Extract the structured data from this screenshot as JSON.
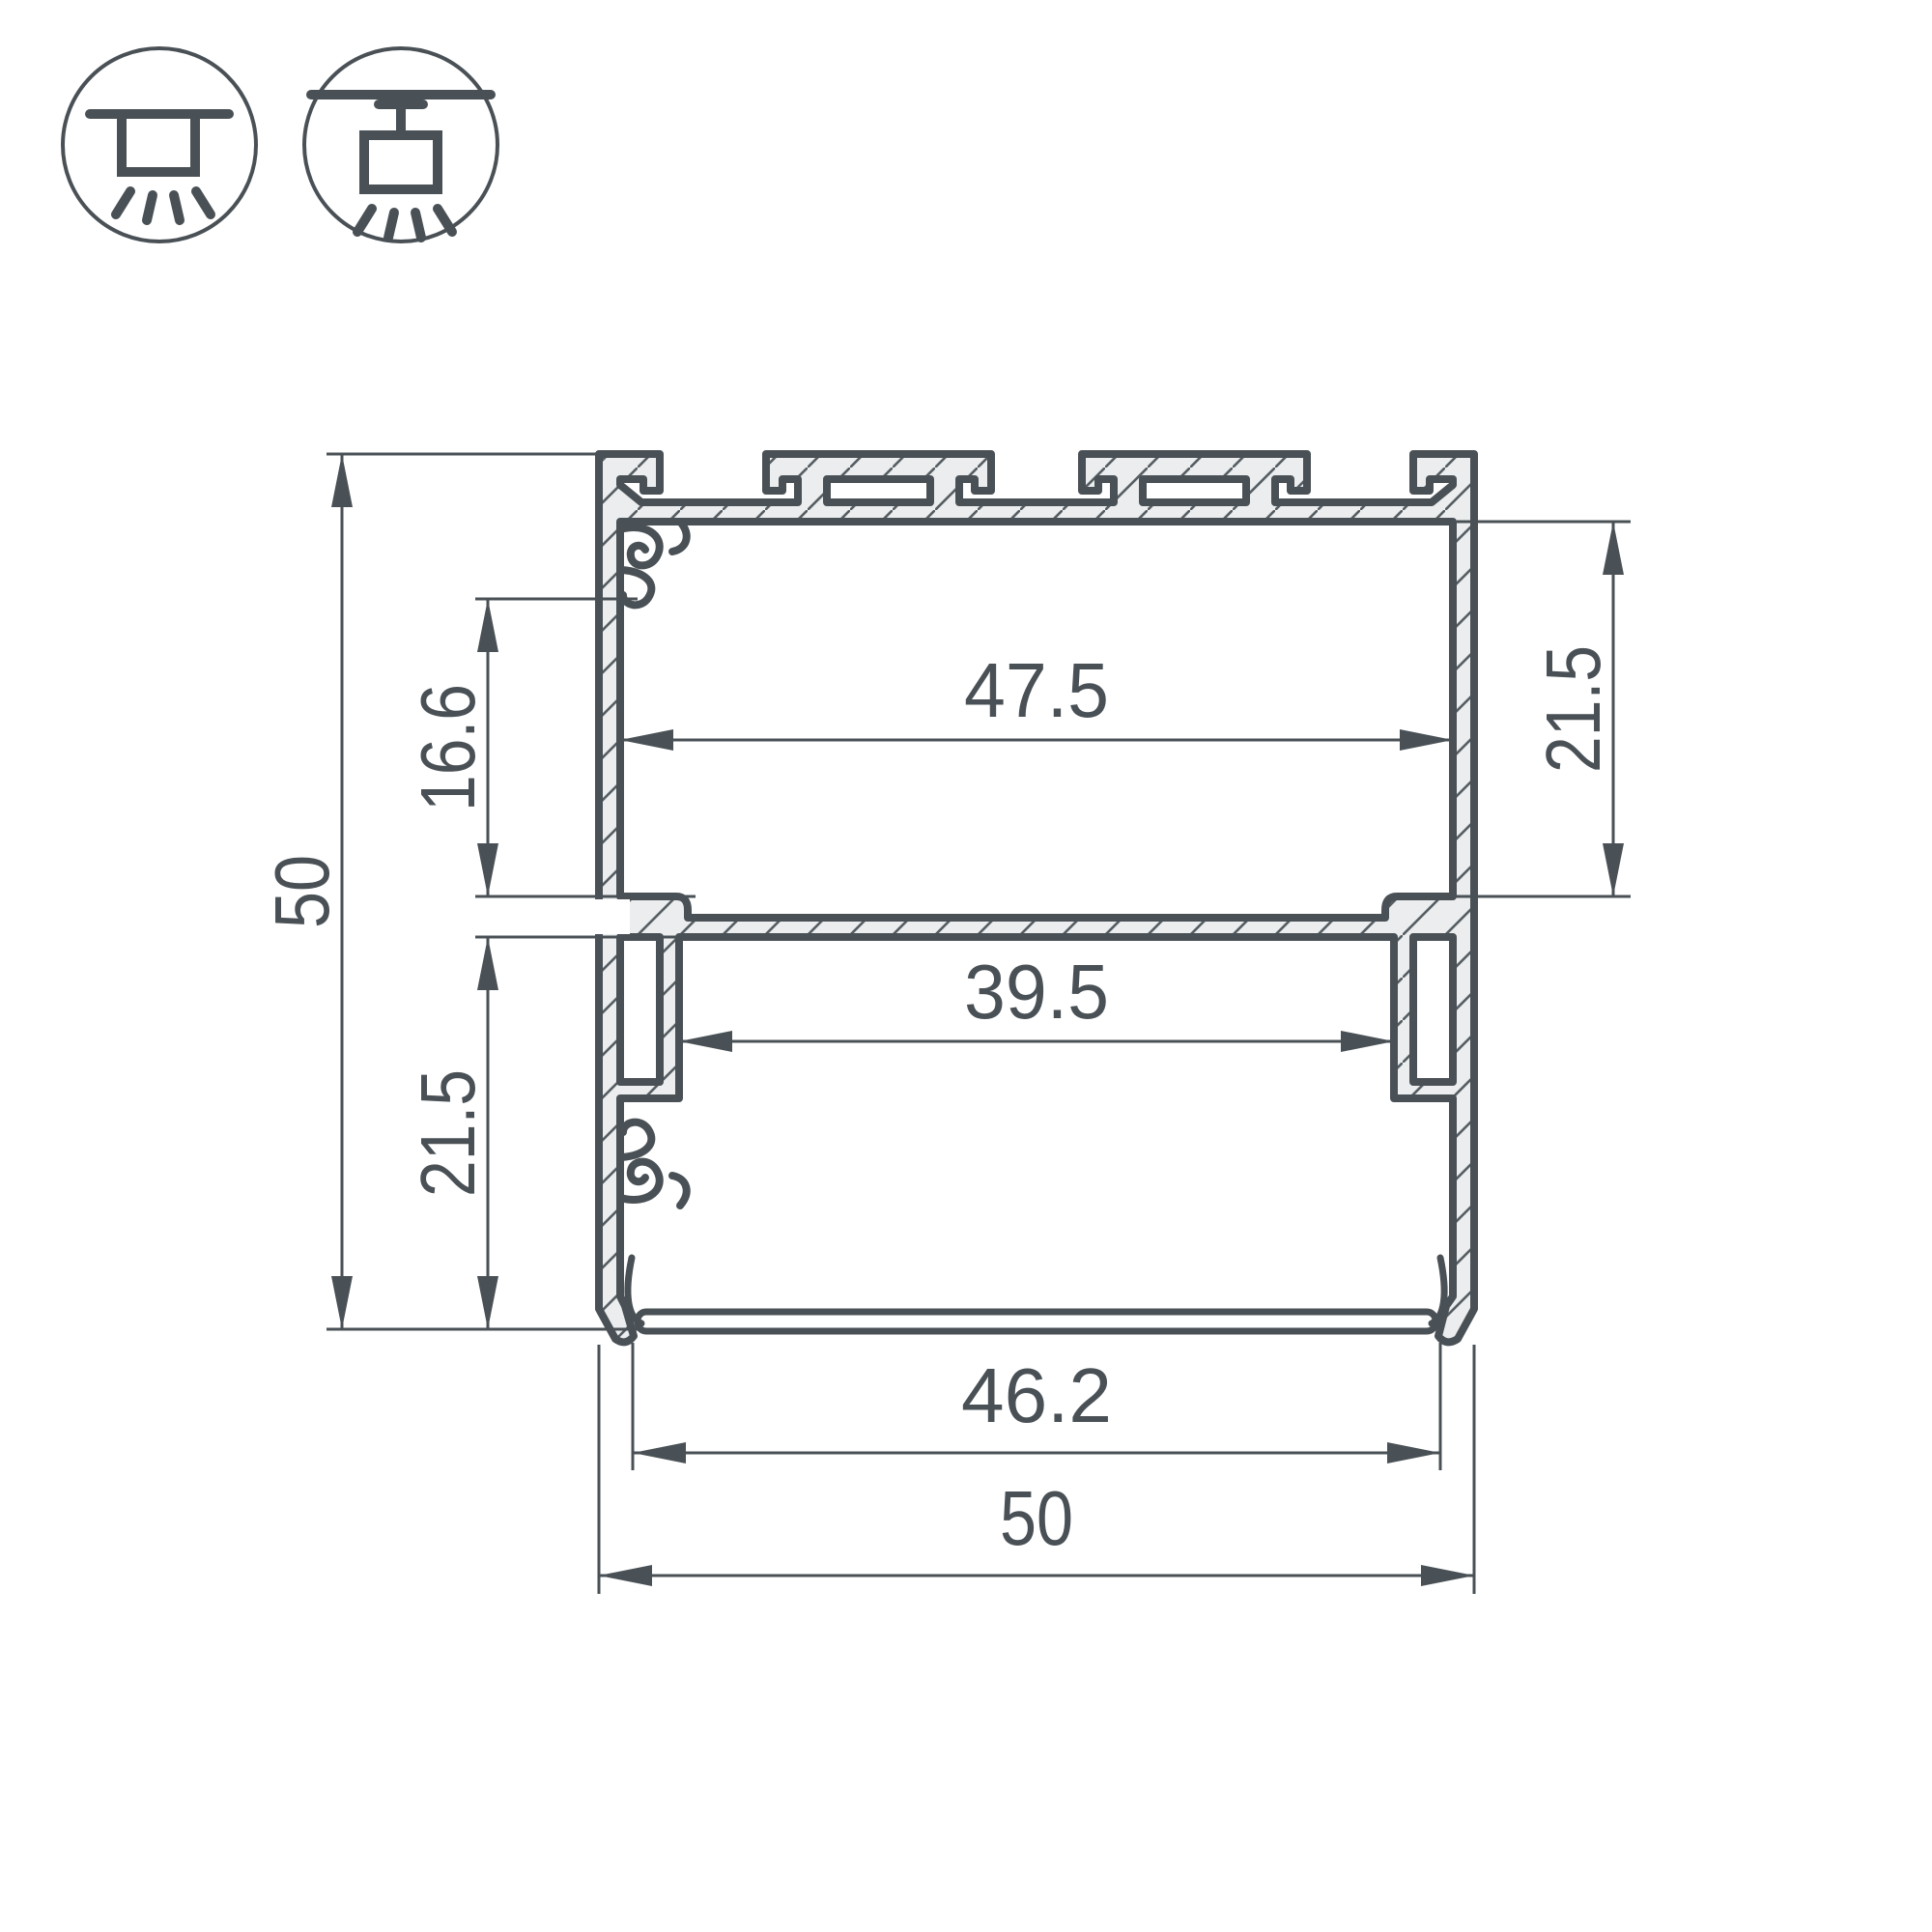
{
  "drawing": {
    "type": "profile-cross-section",
    "colors": {
      "line": "#4a5156",
      "metal_fill": "#ebedee",
      "hatch": "#565e63",
      "background": "#ffffff"
    },
    "icons": [
      {
        "name": "surface-mount-icon"
      },
      {
        "name": "pendant-mount-icon"
      }
    ],
    "dimensions": {
      "overall_height": "50",
      "overall_width": "50",
      "inner_width_top": "47.5",
      "inner_width_lower": "39.5",
      "diffuser_width": "46.2",
      "upper_inset_left": "16.6",
      "cavity_height_right": "21.5",
      "lower_height_left": "21.5"
    }
  }
}
